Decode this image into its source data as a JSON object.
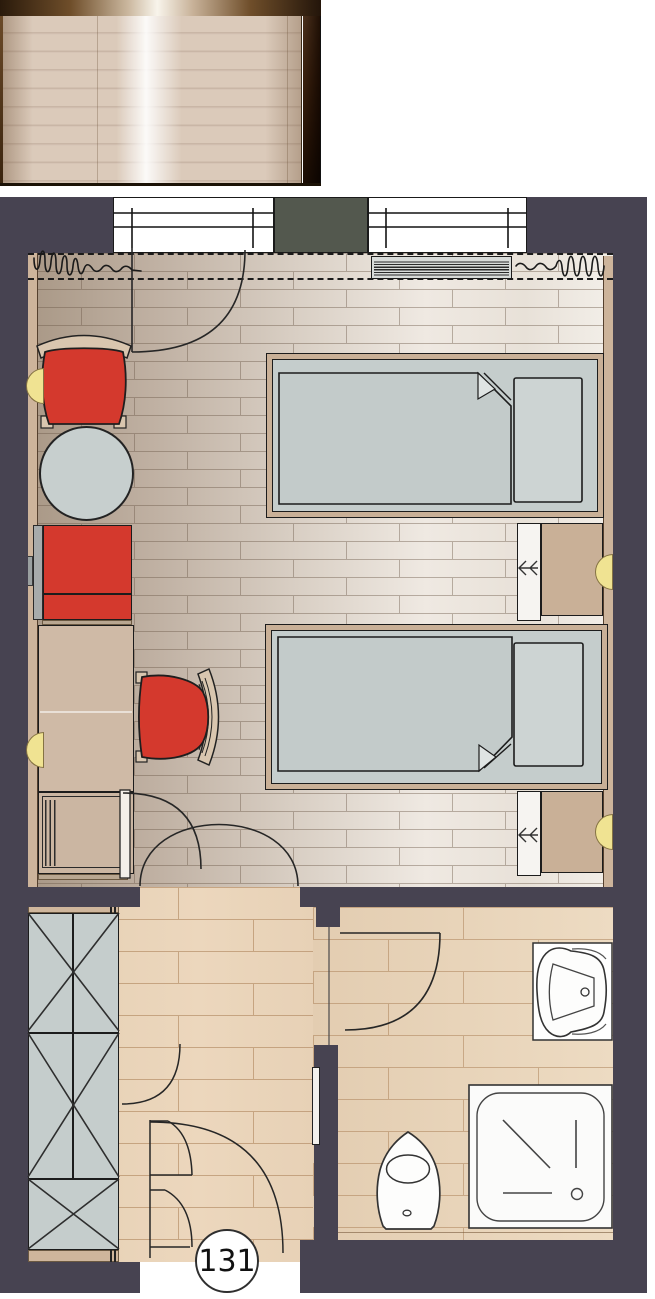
{
  "floor_plan": {
    "room_label": "131",
    "areas": [
      {
        "id": "balcony",
        "label": "balcony"
      },
      {
        "id": "bedroom",
        "label": "bedroom"
      },
      {
        "id": "entry-hall",
        "label": "entry hall"
      },
      {
        "id": "bathroom",
        "label": "bathroom"
      },
      {
        "id": "corridor",
        "label": "corridor"
      }
    ],
    "furniture": [
      "twin-bed-1",
      "twin-bed-2",
      "nightstand-1",
      "nightstand-2",
      "armchair",
      "desk-chair",
      "round-table",
      "sofa",
      "desk",
      "minibar-cabinet",
      "wardrobe",
      "radiator",
      "curtains",
      "washbasin",
      "shower",
      "toilet",
      "wall-lamp-x4",
      "balcony-deck"
    ],
    "colors": {
      "wall": "#474351",
      "window_pillar": "#53584e",
      "accent_red": "#d4392d",
      "mattress_gray": "#c5cdcc",
      "wood_tan": "#c9b097",
      "lamp_yellow": "#f0e392",
      "hall_floor": "#e9d3b8",
      "bedroom_floor_light": "#efe9e2",
      "balcony_frame_brown": "#6f4e2a"
    }
  }
}
